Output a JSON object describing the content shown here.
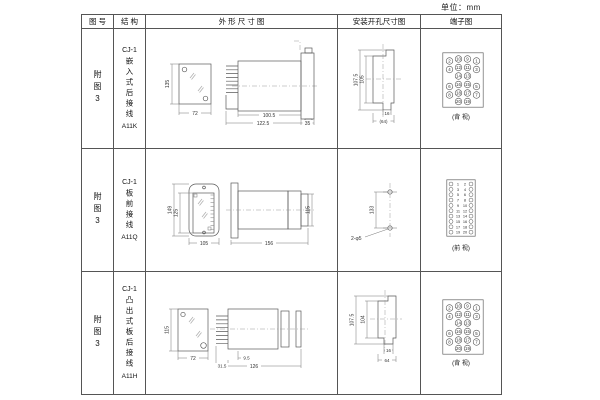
{
  "unit_label": "单位：mm",
  "table": {
    "headers": {
      "figure_no": "图 号",
      "structure": "结 构",
      "outline": "外 形 尺 寸 图",
      "install": "安装开孔尺寸图",
      "terminal": "端子图"
    },
    "rows": [
      {
        "figure_no": "附图3",
        "structure": {
          "model": "CJ-1",
          "desc": "嵌入式后接线",
          "code": "A11K"
        },
        "outline": {
          "front_height": "135",
          "front_width": "72",
          "depth_body": "100.5",
          "depth_total": "122.5",
          "flange": "35"
        },
        "install": {
          "outer_height": "107.5",
          "inner_height": "105",
          "tab_width": "16",
          "cutout_width": "(64)"
        },
        "terminal": {
          "view_label": "(背 视)",
          "grid": [
            [
              "2",
              "10",
              "9",
              "1"
            ],
            [
              "4",
              "12",
              "11",
              "3"
            ],
            [
              "",
              "14",
              "13",
              ""
            ],
            [
              "6",
              "16",
              "15",
              "5"
            ],
            [
              "8",
              "18",
              "17",
              "7"
            ],
            [
              "",
              "20",
              "19",
              ""
            ]
          ]
        }
      },
      {
        "figure_no": "附图3",
        "structure": {
          "model": "CJ-1",
          "desc": "板前接线",
          "code": "A11Q"
        },
        "outline": {
          "front_height": "149",
          "inner_height": "125",
          "front_width": "105",
          "depth_total": "156",
          "body_height": "115"
        },
        "install": {
          "hole_spacing": "133",
          "hole_label": "2-φ5"
        },
        "terminal": {
          "view_label": "(前 视)",
          "pairs": [
            [
              "1",
              "2"
            ],
            [
              "3",
              "4"
            ],
            [
              "5",
              "6"
            ],
            [
              "7",
              "8"
            ],
            [
              "9",
              "10"
            ],
            [
              "11",
              "12"
            ],
            [
              "13",
              "14"
            ],
            [
              "15",
              "16"
            ],
            [
              "17",
              "18"
            ],
            [
              "19",
              "20"
            ]
          ]
        }
      },
      {
        "figure_no": "附图3",
        "structure": {
          "model": "CJ-1",
          "desc": "凸出式板后接线",
          "code": "A11H"
        },
        "outline": {
          "front_height": "115",
          "front_width": "72",
          "pin_depth": "31.5",
          "gap": "9.5",
          "depth_total": "126"
        },
        "install": {
          "outer_height": "107.5",
          "inner_height": "104",
          "tab_width": "16",
          "cutout_width": "64"
        },
        "terminal": {
          "view_label": "(背 视)",
          "grid": [
            [
              "2",
              "10",
              "9",
              "1"
            ],
            [
              "4",
              "12",
              "11",
              "3"
            ],
            [
              "",
              "14",
              "13",
              ""
            ],
            [
              "6",
              "16",
              "15",
              "5"
            ],
            [
              "8",
              "18",
              "17",
              "7"
            ],
            [
              "",
              "20",
              "19",
              ""
            ]
          ]
        }
      }
    ]
  }
}
